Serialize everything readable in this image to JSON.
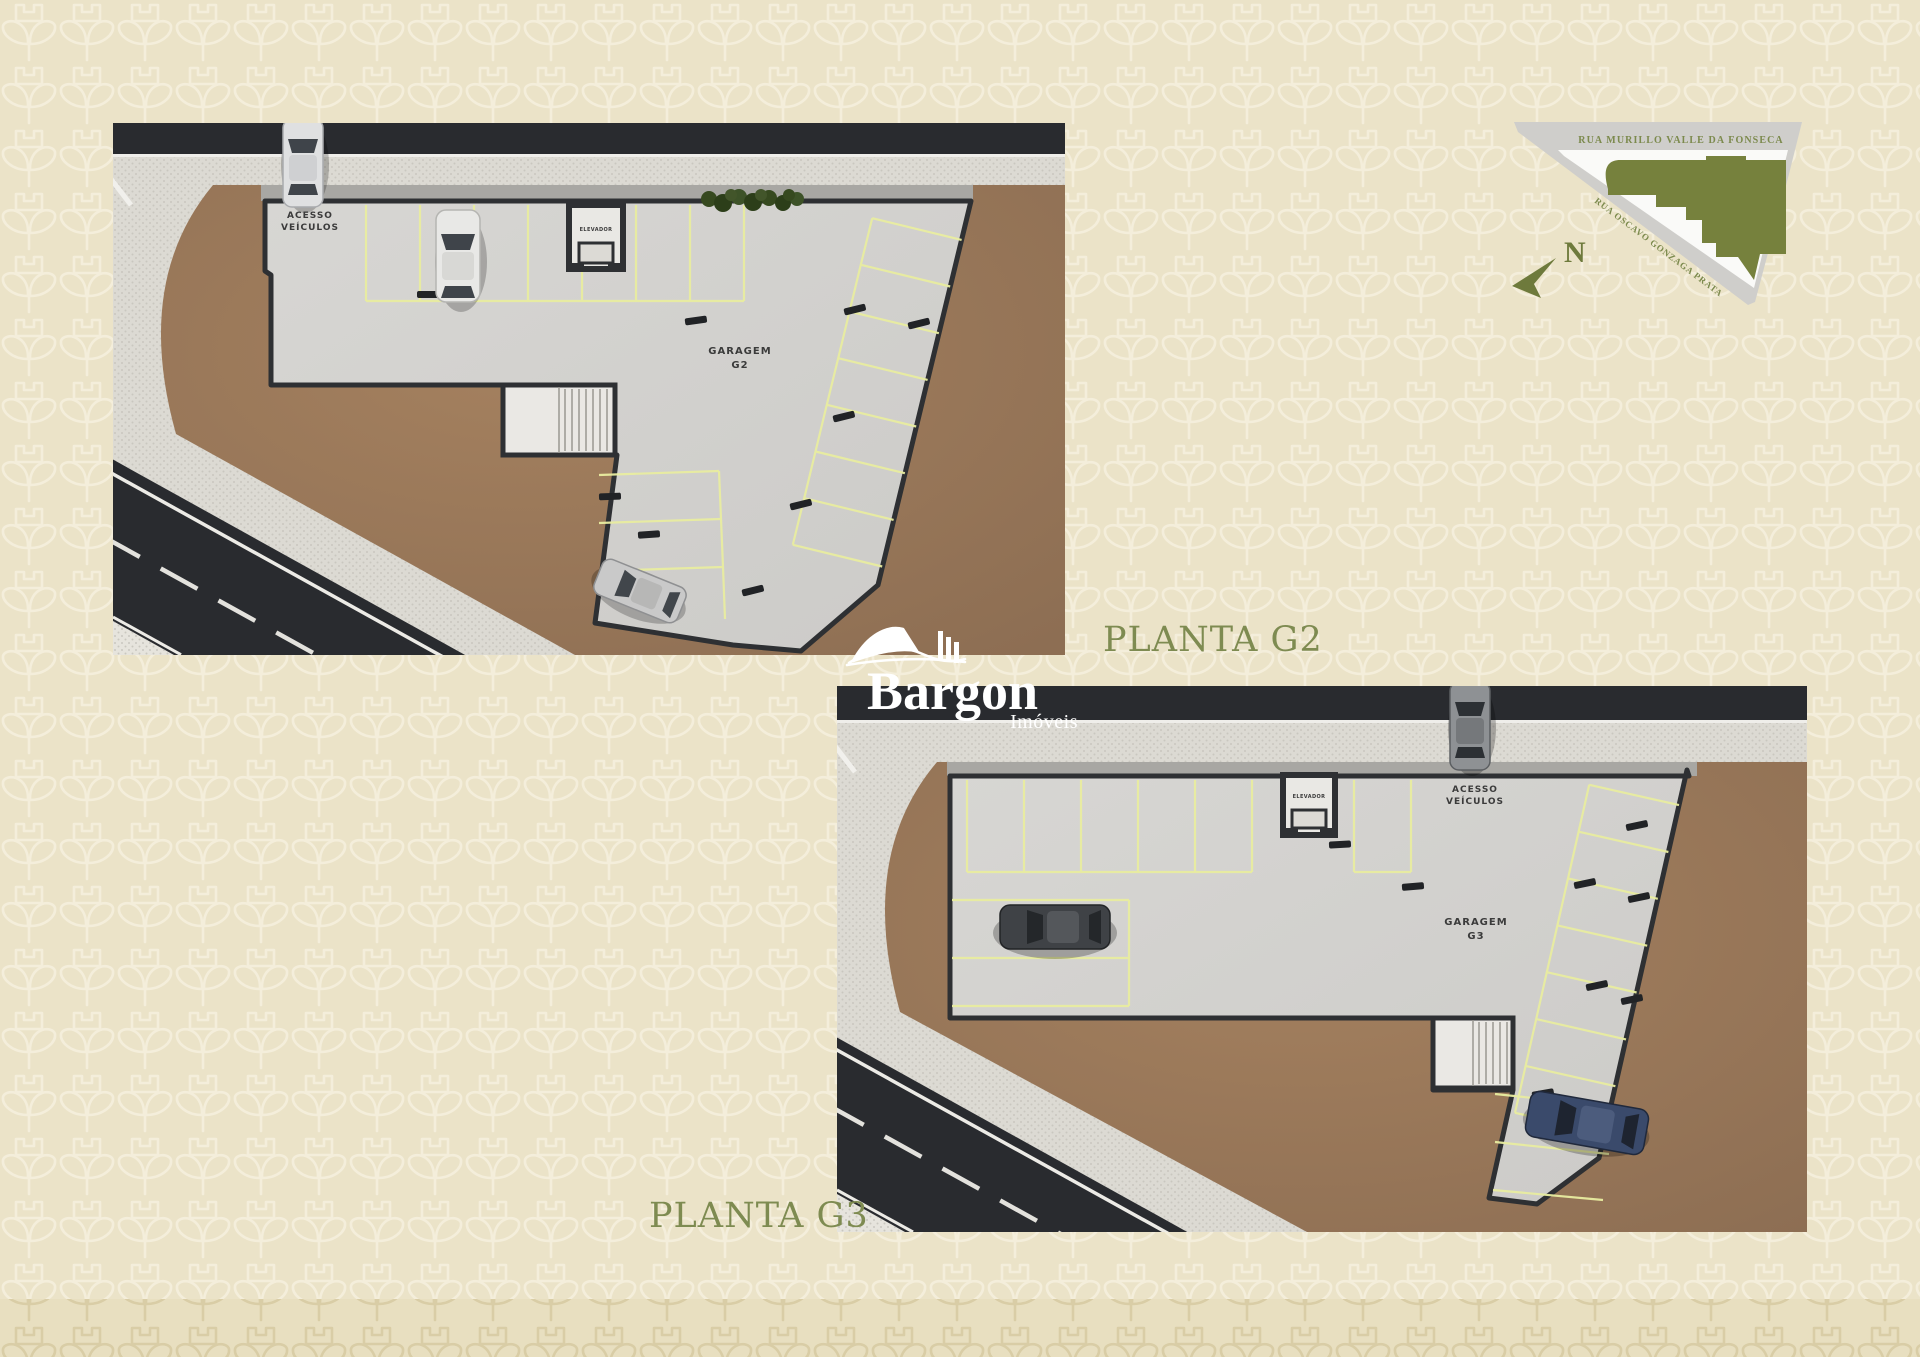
{
  "page": {
    "background": "#ebe3c8",
    "pattern_stroke": "#f4eedb",
    "bottom_band_background": "#e8dfc0",
    "bottom_band_stroke": "#d9cda6"
  },
  "branding": {
    "name": "Bargon",
    "subtitle": "Imóveis",
    "color": "#ffffff"
  },
  "plan_g2": {
    "caption": "PLANTA G2",
    "garage_line1": "GARAGEM",
    "garage_line2": "G2",
    "access_line1": "ACESSO",
    "access_line2": "VEÍCULOS",
    "elevator": "ELEVADOR"
  },
  "plan_g3": {
    "caption": "PLANTA G3",
    "garage_line1": "GARAGEM",
    "garage_line2": "G3",
    "access_line1": "ACESSO",
    "access_line2": "VEÍCULOS",
    "elevator": "ELEVADOR"
  },
  "map": {
    "street_top": "RUA MURILLO VALLE DA FONSECA",
    "street_side": "RUA OSCAVO GONZAGA PRATA",
    "north": "N",
    "building_color": "#76813d",
    "street_fill": "#cfcecb",
    "block_fill": "#fafaf8",
    "text_color": "#7c8a4d"
  },
  "colors": {
    "caption_text": "#7e8b51",
    "asphalt": "#292b2f",
    "sidewalk": "#dcdad3",
    "dirt": "#9c7a5d",
    "garage_floor": "#d3d2cf",
    "wall": "#2e3033",
    "parking_line": "#e9eda0"
  }
}
